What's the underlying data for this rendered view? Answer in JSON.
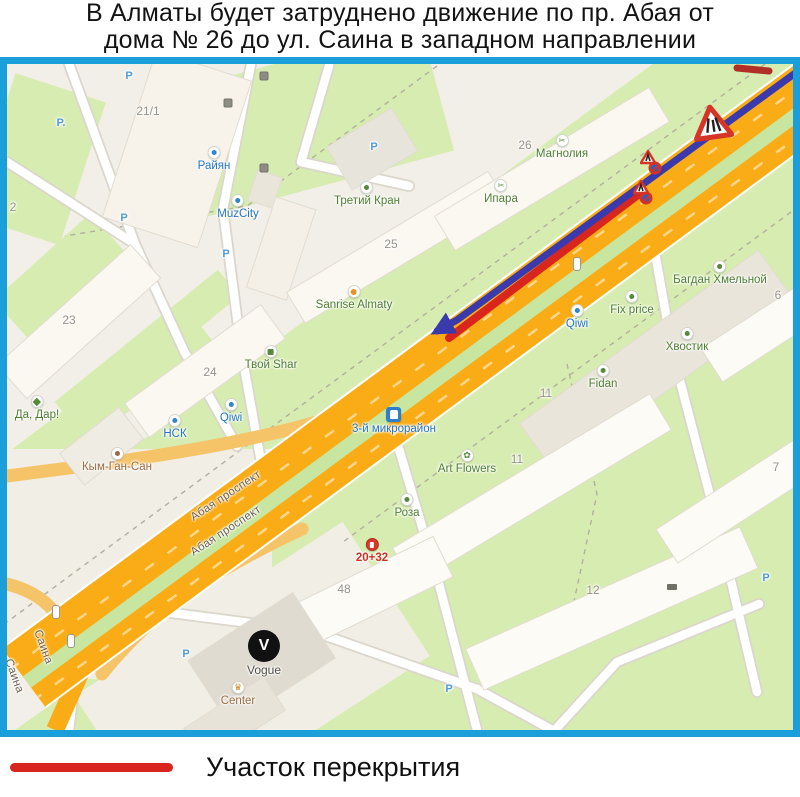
{
  "title": {
    "line1": "В Алматы будет затруднено движение по пр. Абая от",
    "line2": "дома № 26 до ул. Саина в западном направлении"
  },
  "legend": {
    "closure_label": "Участок перекрытия"
  },
  "colors": {
    "frame_blue": "#1a9fdb",
    "road_orange": "#f9ac15",
    "ramp_orange": "#f6c468",
    "median_green": "#c8e6a0",
    "area_green": "#d7ecb0",
    "land_beige": "#f2efe8",
    "closure_red": "#d8251d",
    "route_blue": "#3a3aad"
  },
  "map": {
    "street_labels": [
      "Абая проспект",
      "Абая проспект",
      "Саина",
      "Саина"
    ],
    "building_numbers": [
      "21/1",
      "25",
      "26",
      "2",
      "23",
      "24",
      "11",
      "11",
      "48",
      "12",
      "6",
      "7"
    ],
    "parking_markers": [
      "P",
      "P.",
      "P",
      "P",
      "P",
      "P",
      "P",
      "P"
    ],
    "pois_blue": [
      "Райян",
      "MuzCity",
      "НСК",
      "Qiwi",
      "Qiwi",
      "3-й микрорайон"
    ],
    "pois_green": [
      "Третий Кран",
      "Ипара",
      "Магнолия",
      "Багдан Хмельной",
      "Fix price",
      "Хвостик",
      "Fidan",
      "Art Flowers",
      "Роза",
      "Твой Shar",
      "Да, Дар!",
      "Sanrise Almaty"
    ],
    "pois_brown": [
      "Кым-Ган-Сан",
      "Center"
    ],
    "pois_dark": [
      "Vogue"
    ],
    "pois_red": [
      "20+32"
    ],
    "vogue_letter": "V"
  }
}
